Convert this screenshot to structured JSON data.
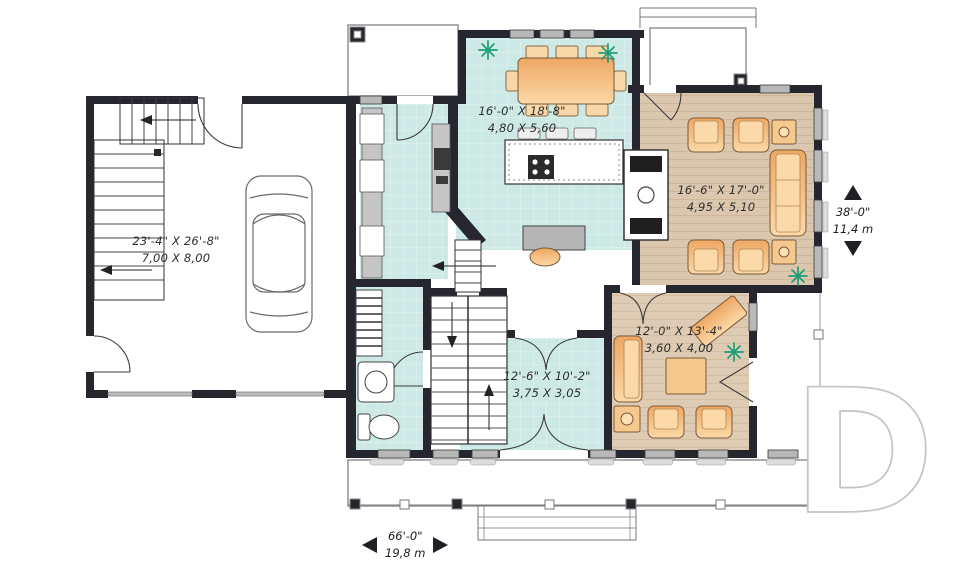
{
  "plan": {
    "rooms": {
      "garage": {
        "imperial": "23'-4\" X 26'-8\"",
        "metric": "7,00 X 8,00"
      },
      "kitchen": {
        "imperial": "16'-0\" X 18'-8\"",
        "metric": "4,80 X 5,60"
      },
      "living": {
        "imperial": "16'-6\" X 17'-0\"",
        "metric": "4,95 X 5,10"
      },
      "den": {
        "imperial": "12'-0\" X 13'-4\"",
        "metric": "3,60 X 4,00"
      },
      "foyer": {
        "imperial": "12'-6\" X 10'-2\"",
        "metric": "3,75 X 3,05"
      }
    },
    "dimensions": {
      "depth": {
        "imperial": "38'-0\"",
        "metric": "11,4 m"
      },
      "width": {
        "imperial": "66'-0\"",
        "metric": "19,8 m"
      }
    },
    "watermark": "D",
    "colors": {
      "wall": "#26262e",
      "tile_floor": "#cde9e5",
      "wood_floor": "#dbc7ae",
      "furniture": "#f2b377",
      "plant": "#1d9e76"
    }
  }
}
